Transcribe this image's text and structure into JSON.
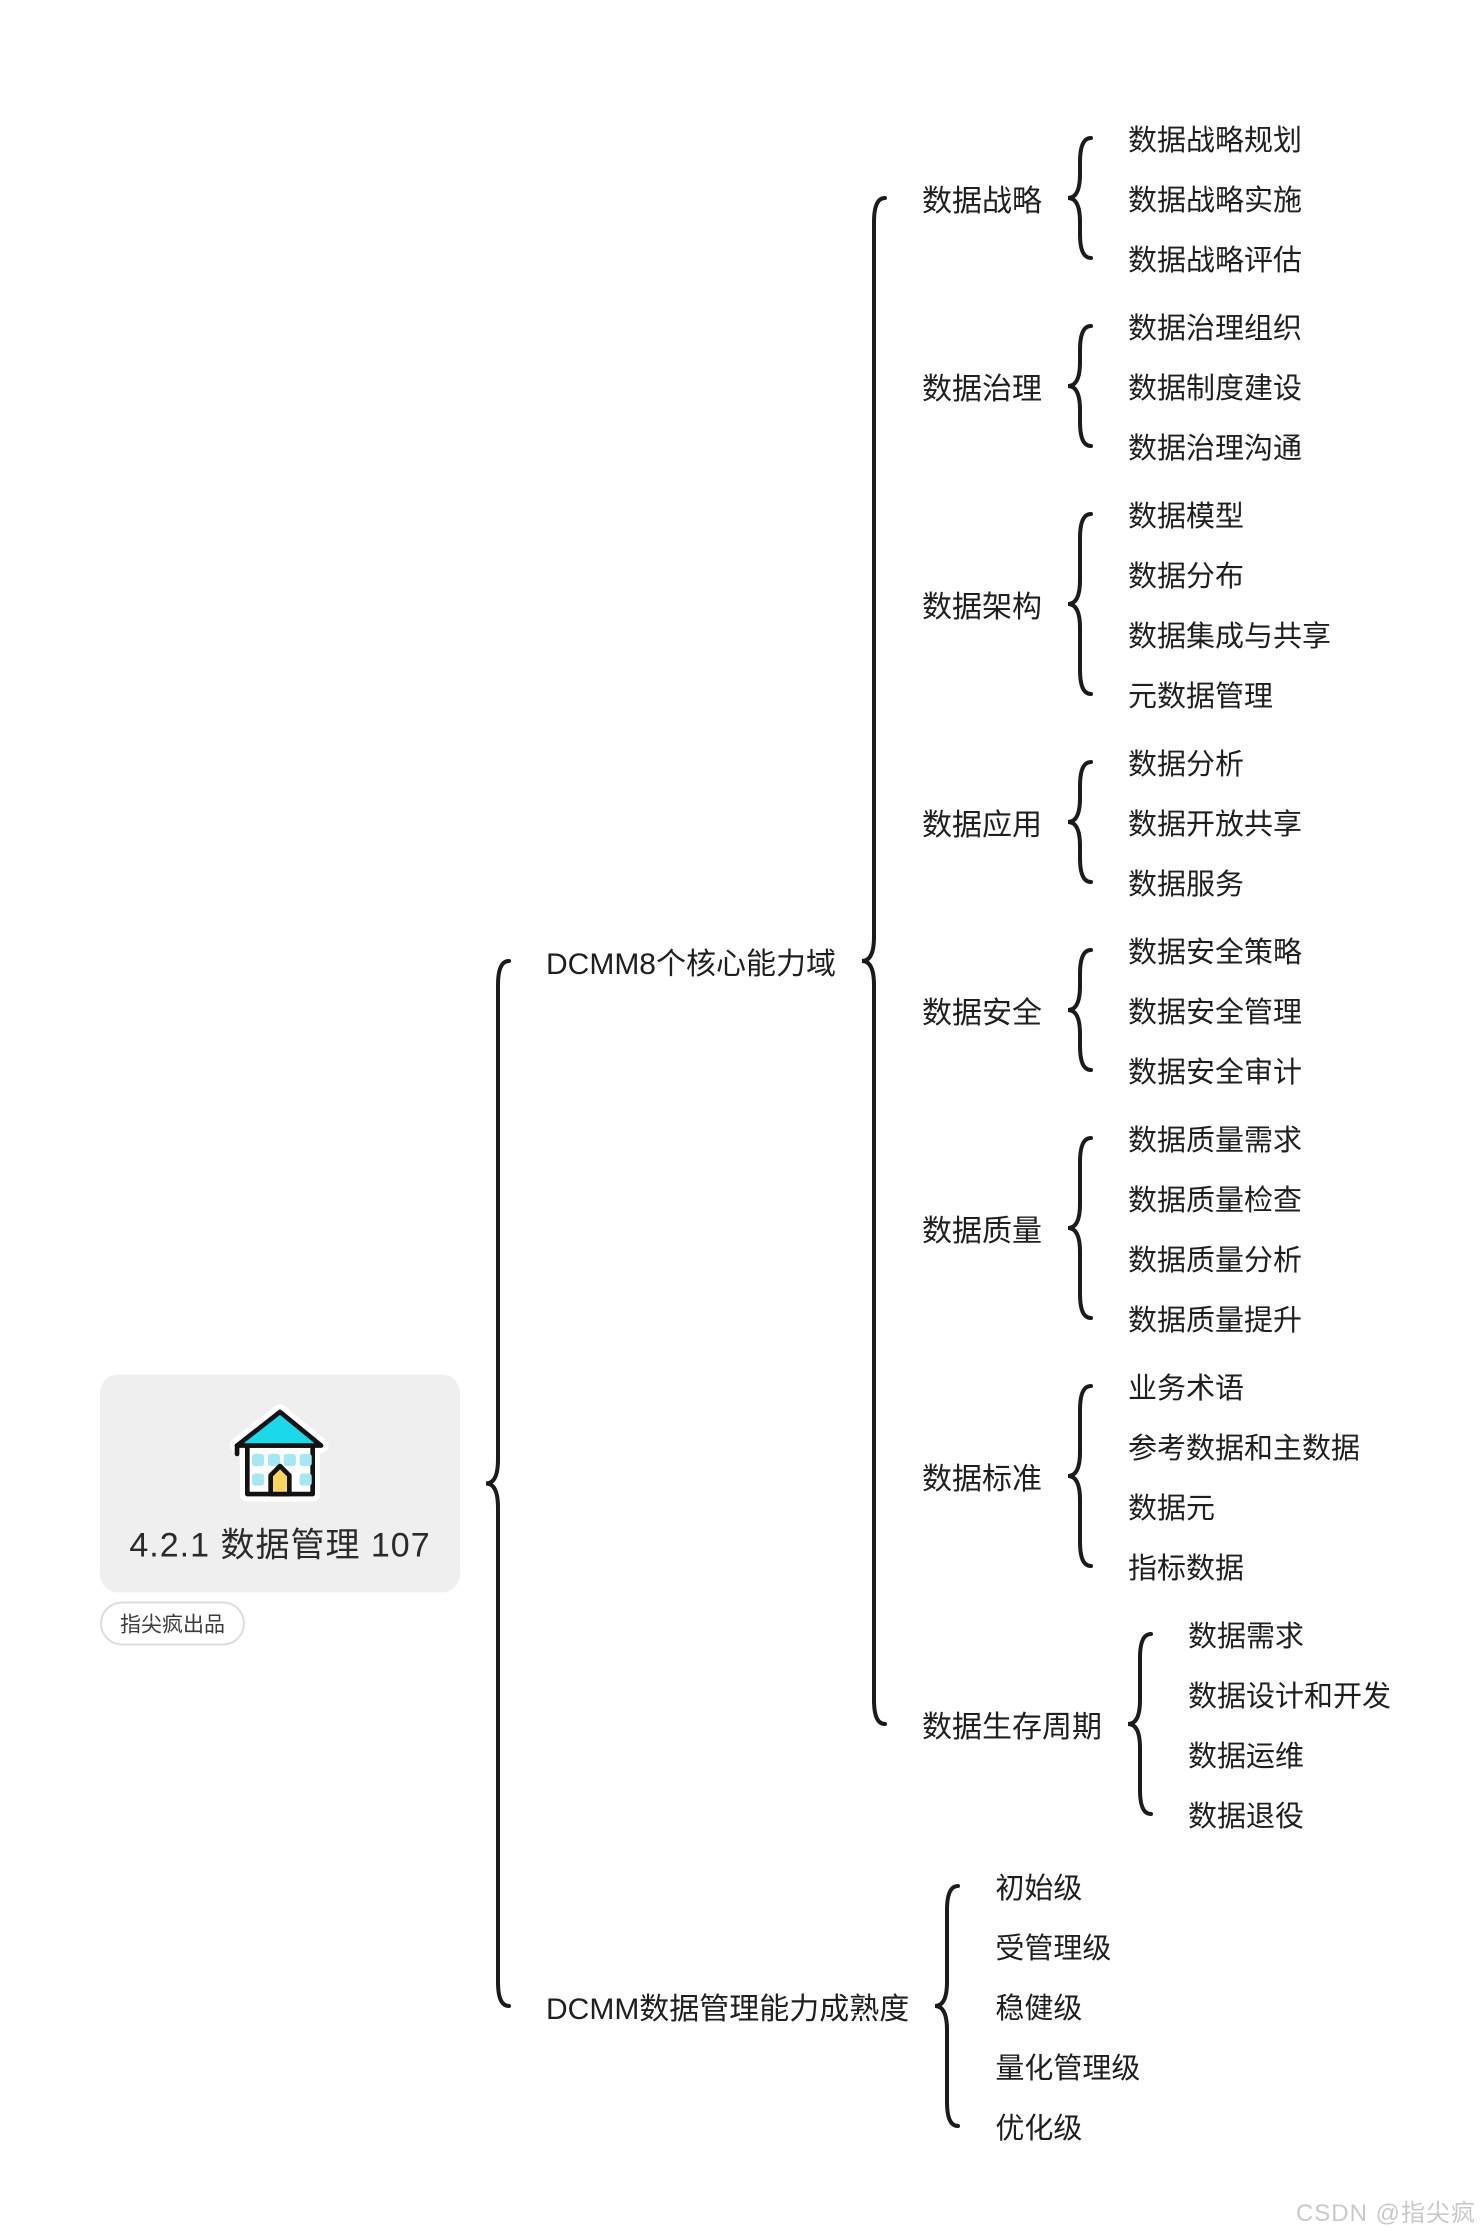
{
  "root": {
    "title": "4.2.1  数据管理  107",
    "badge": "指尖疯出品",
    "icon": "school-building-icon"
  },
  "watermark": "CSDN @指尖疯",
  "colors": {
    "text": "#1f1f1f",
    "brace": "#1b1b1b",
    "card_bg": "#efefef",
    "badge_border": "#dcdcdc",
    "roof": "#1bd9e9",
    "window": "#a7e6f4",
    "door": "#fad55f",
    "outline": "#131313",
    "halo": "#ffffff",
    "watermark": "#c9c9c9"
  },
  "tree": [
    {
      "label": "DCMM8个核心能力域",
      "children": [
        {
          "label": "数据战略",
          "children": [
            "数据战略规划",
            "数据战略实施",
            "数据战略评估"
          ]
        },
        {
          "label": "数据治理",
          "children": [
            "数据治理组织",
            "数据制度建设",
            "数据治理沟通"
          ]
        },
        {
          "label": "数据架构",
          "children": [
            "数据模型",
            "数据分布",
            "数据集成与共享",
            "元数据管理"
          ]
        },
        {
          "label": "数据应用",
          "children": [
            "数据分析",
            "数据开放共享",
            "数据服务"
          ]
        },
        {
          "label": "数据安全",
          "children": [
            "数据安全策略",
            "数据安全管理",
            "数据安全审计"
          ]
        },
        {
          "label": "数据质量",
          "children": [
            "数据质量需求",
            "数据质量检查",
            "数据质量分析",
            "数据质量提升"
          ]
        },
        {
          "label": "数据标准",
          "children": [
            "业务术语",
            "参考数据和主数据",
            "数据元",
            "指标数据"
          ]
        },
        {
          "label": "数据生存周期",
          "children": [
            "数据需求",
            "数据设计和开发",
            "数据运维",
            "数据退役"
          ]
        }
      ]
    },
    {
      "label": "DCMM数据管理能力成熟度",
      "children": [
        "初始级",
        "受管理级",
        "稳健级",
        "量化管理级",
        "优化级"
      ]
    }
  ]
}
